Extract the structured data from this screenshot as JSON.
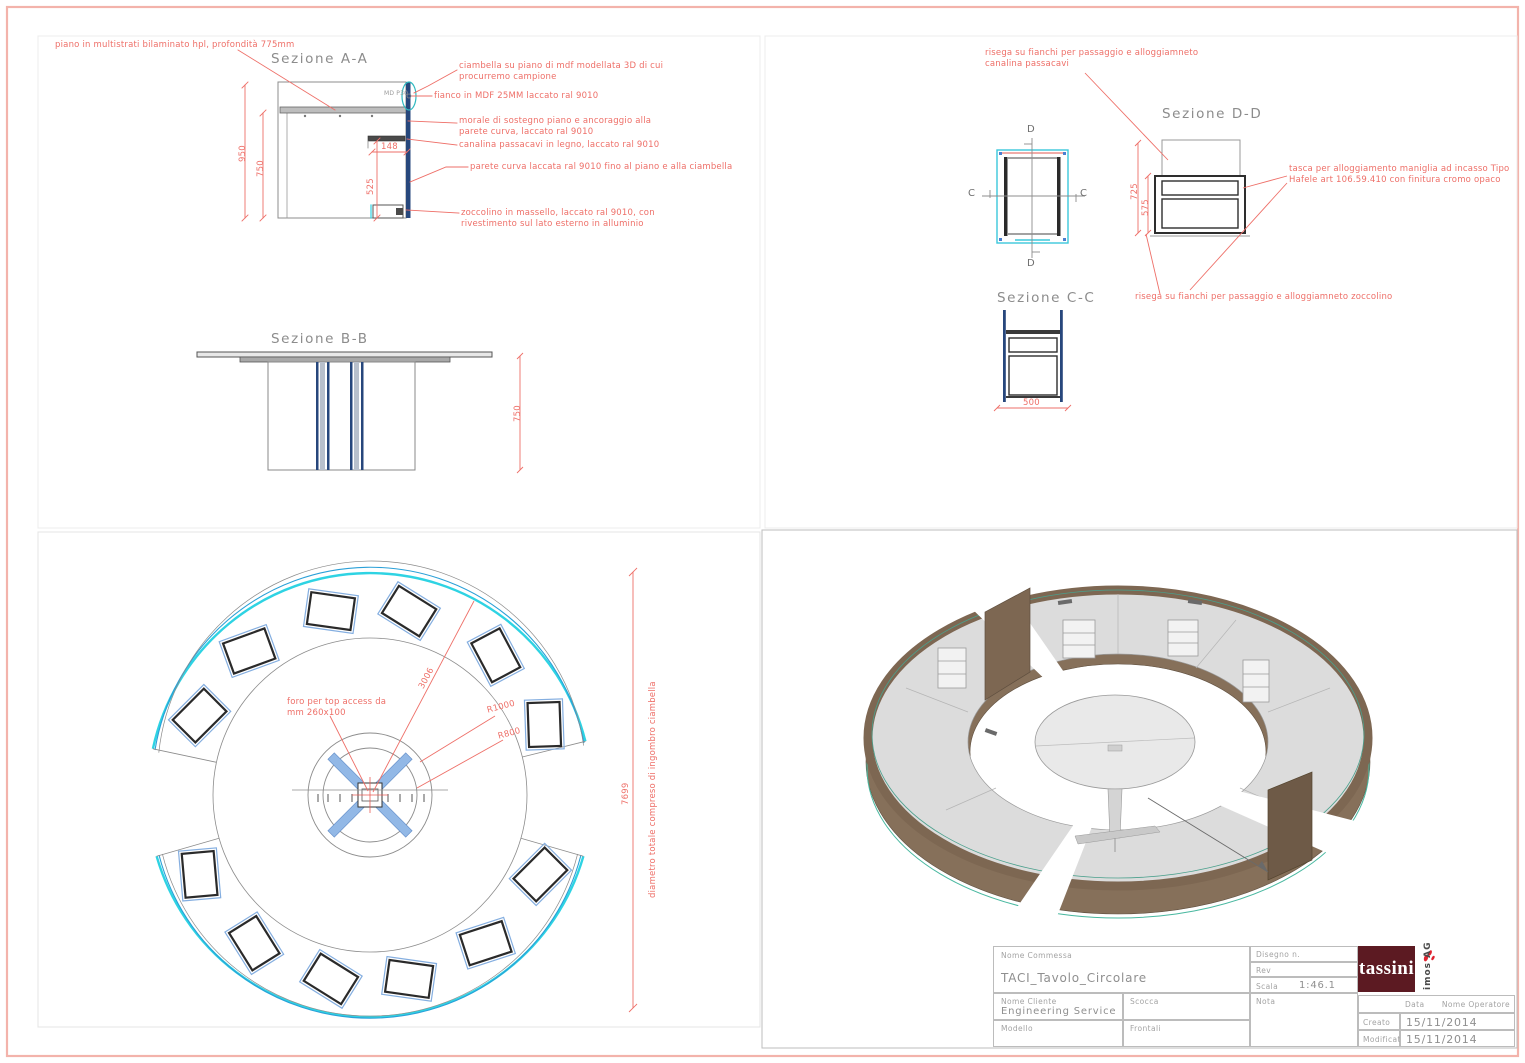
{
  "sections": {
    "aa": {
      "title": "Sezione A-A",
      "ann_piano": "piano in multistrati bilaminato hpl, profondità 775mm",
      "ann_ciambella": "ciambella su piano di mdf modellata 3D di cui procurremo campione",
      "ann_fianco": "fianco in MDF 25MM laccato ral 9010",
      "ann_morale": "morale di sostegno piano e ancoraggio alla parete curva, laccato ral 9010",
      "ann_canalina": "canalina passacavi in legno, laccato ral 9010",
      "ann_parete": "parete curva laccata ral 9010 fino al piano e alla ciambella",
      "ann_zoccolino": "zoccolino in massello, laccato ral 9010, con rivestimento sul lato esterno in alluminio",
      "hatch_label": "MD P30",
      "dim_950": "950",
      "dim_750": "750",
      "dim_148": "148",
      "dim_525": "525"
    },
    "bb": {
      "title": "Sezione B-B",
      "dim_750": "750"
    },
    "dd": {
      "title": "Sezione D-D",
      "ann_risega_canalina": "risega su fianchi per passaggio e alloggiamneto canalina passacavi",
      "ann_tasca": "tasca per alloggiamento maniglia ad incasso Tipo Hafele art 106.59.410 con finitura cromo opaco",
      "ann_risega_zoccolino": "risega su fianchi per passaggio e alloggiamneto zoccolino",
      "dim_725": "725",
      "dim_575": "575",
      "cut_c": "C",
      "cut_d": "D"
    },
    "cc": {
      "title": "Sezione C-C",
      "dim_500": "500"
    },
    "plan": {
      "ann_foro": "foro per top access da mm 260x100",
      "ann_diametro": "diametro totale compreso di ingombro ciambella",
      "dim_3006": "3006",
      "dim_r1000": "R1000",
      "dim_r800": "R800",
      "dim_7699": "7699"
    }
  },
  "titleblock": {
    "nome_commessa_label": "Nome Commessa",
    "nome_commessa_value": "TACI_Tavolo_Circolare",
    "disegno_label": "Disegno n.",
    "rev_label": "Rev",
    "scala_label": "Scala",
    "scala_value": "1:46.1",
    "nome_cliente_label": "Nome Cliente",
    "nome_cliente_value": "Engineering Service",
    "scocca_label": "Scocca",
    "modello_label": "Modello",
    "frontali_label": "Frontali",
    "nota_label": "Nota",
    "data_label": "Data",
    "operatore_label": "Nome Operatore",
    "creato_label": "Creato",
    "creato_value": "15/11/2014",
    "modificato_label": "Modificato",
    "modificato_value": "15/11/2014",
    "logo_text": "tassini",
    "imos_text": "imos AG"
  },
  "colors": {
    "annotation_red": "#ee6f68",
    "cyan": "#2ed3e3",
    "navy": "#27477c",
    "steel_blue": "#7ba3dc",
    "wood": "#8a7158",
    "wood_dark": "#6e5a47",
    "surface_gray": "#dcdcdc",
    "logo_maroon": "#5c1a22",
    "page_border_pink": "#f3b3ab"
  }
}
